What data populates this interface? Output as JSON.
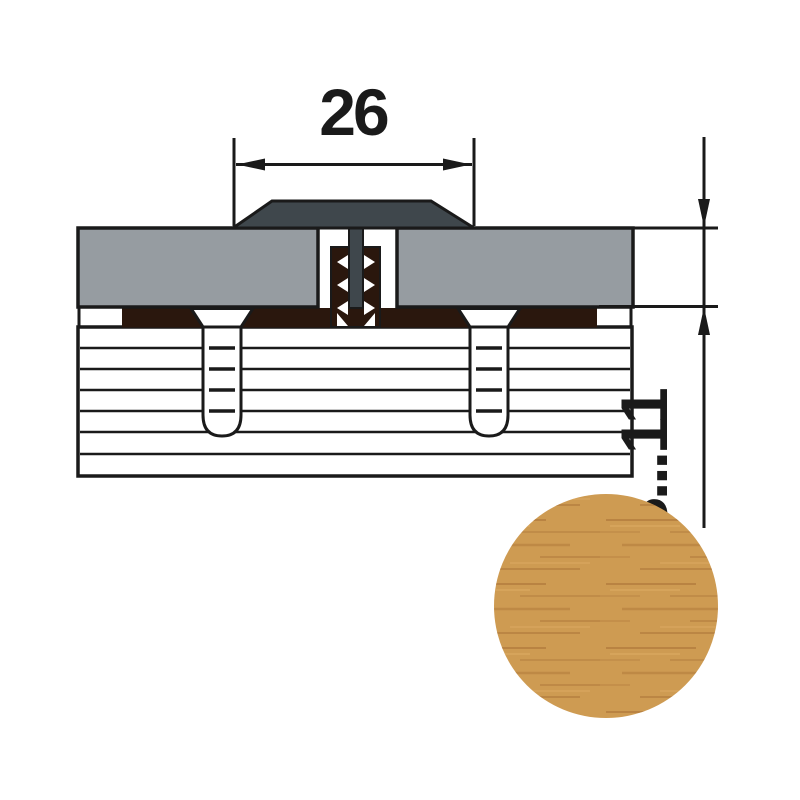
{
  "drawing": {
    "width_dimension": "26",
    "thickness_dimension": "8...11"
  },
  "colors": {
    "cap": "#3F474C",
    "panel": "#969CA1",
    "channel": "#2A170D",
    "outline": "#1A1A1A",
    "wood_base": "#CE9B52",
    "grain_dark": "#A46C32",
    "grain_light": "#E3B269"
  }
}
